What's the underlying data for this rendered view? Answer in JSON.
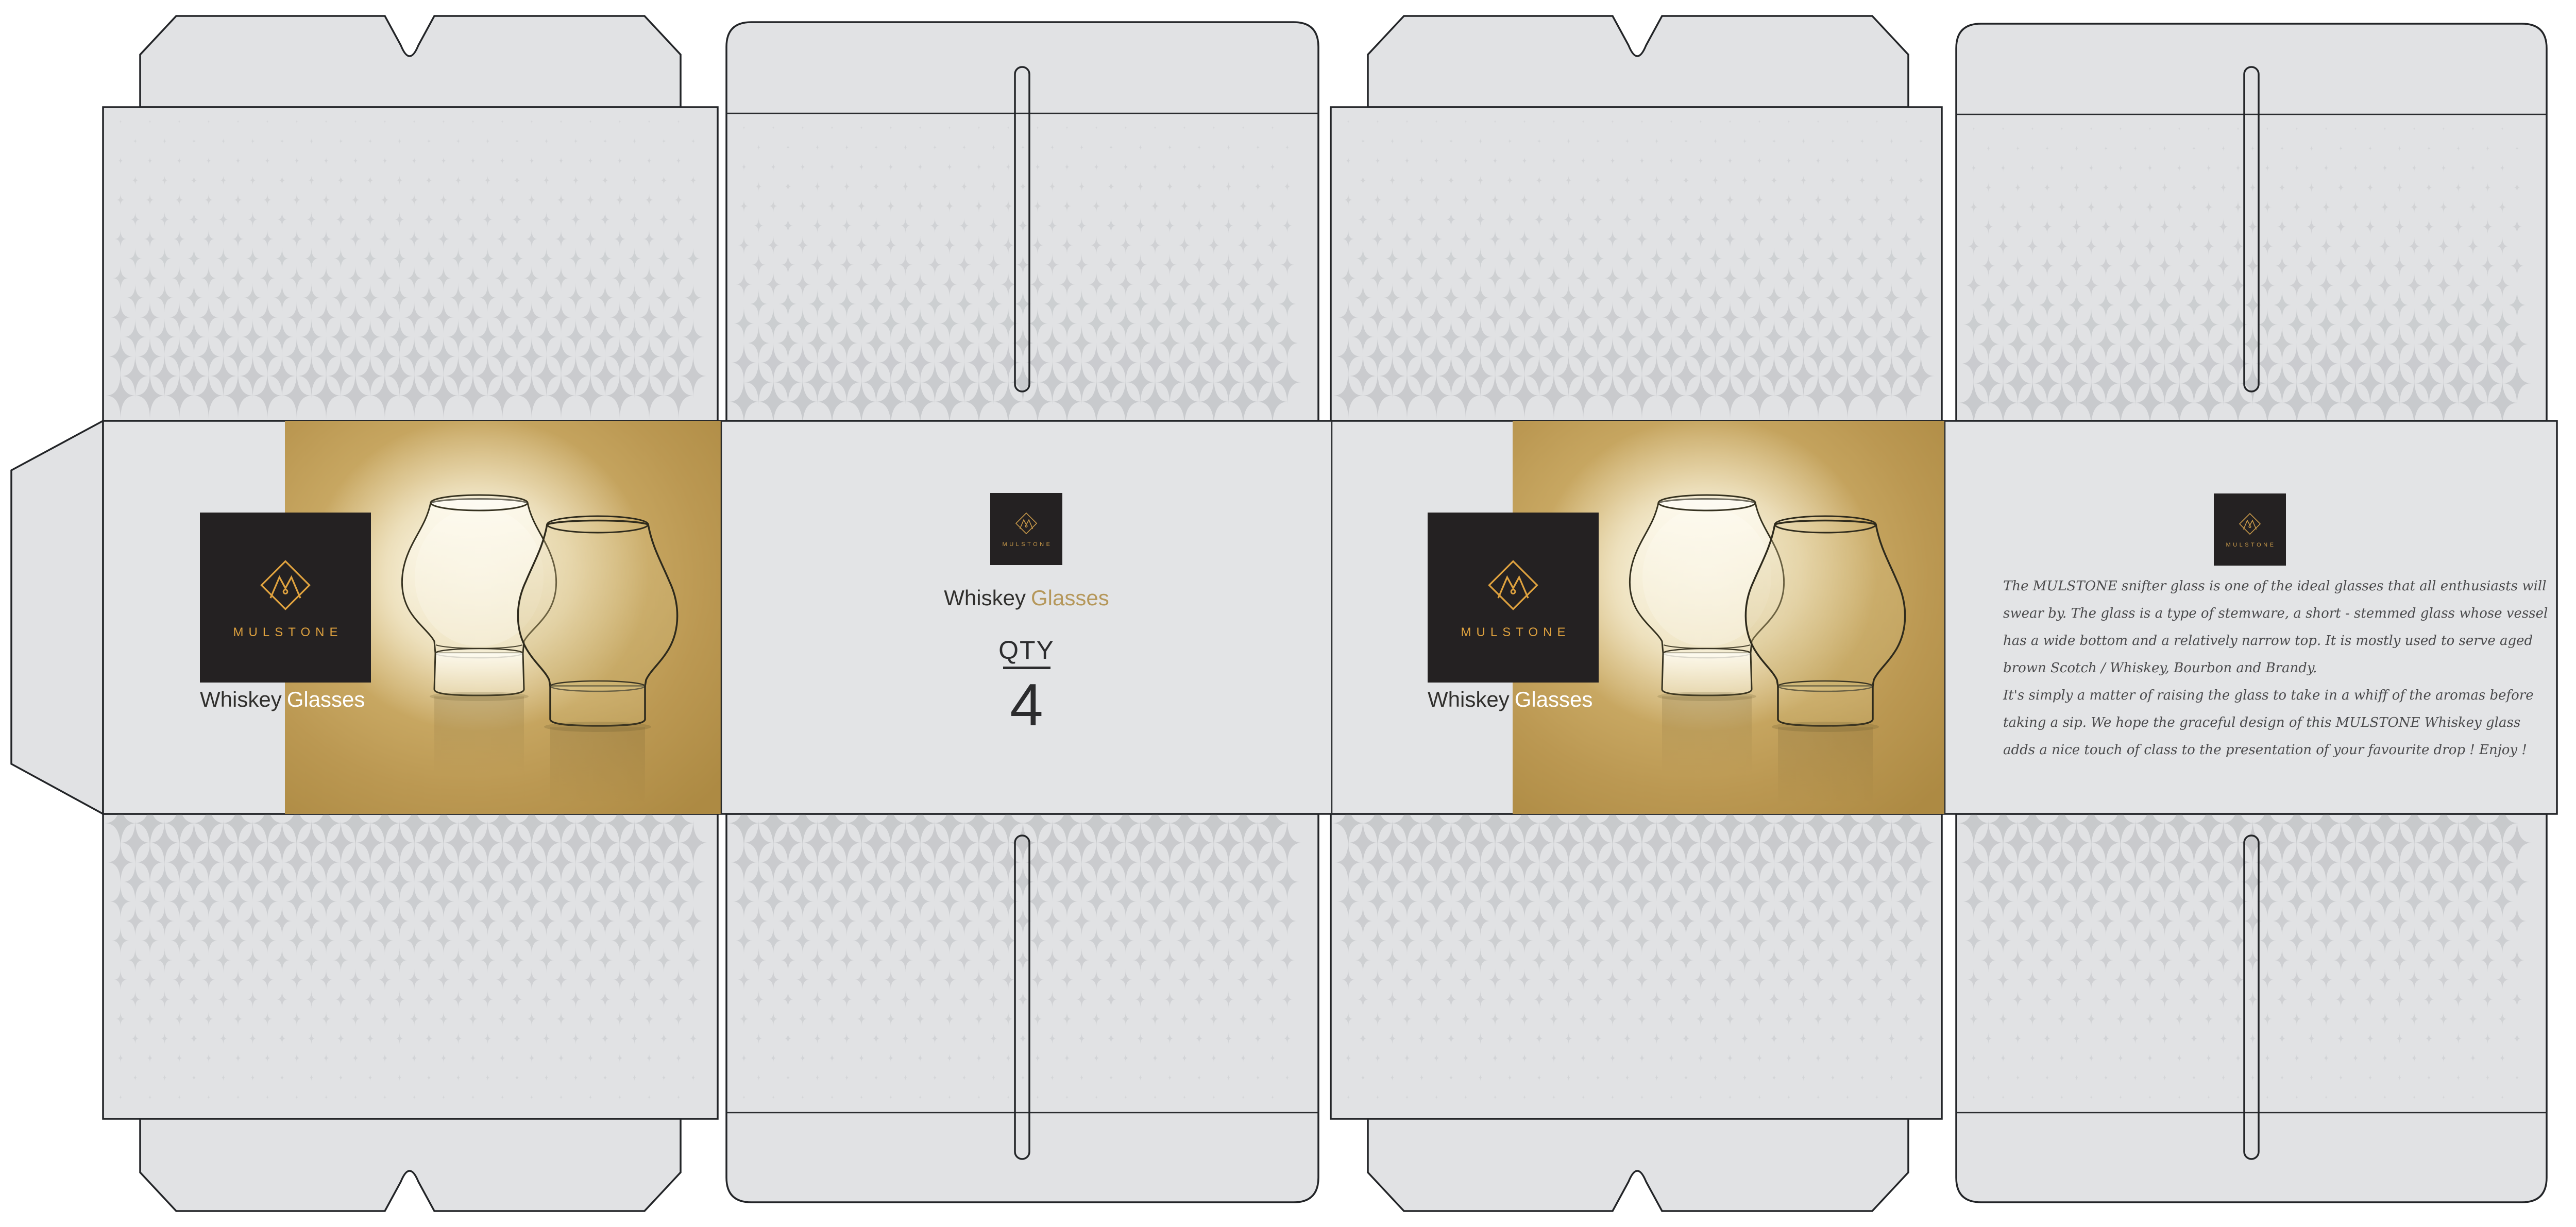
{
  "brand": {
    "wordmark": "MULSTONE",
    "monogram": "M"
  },
  "panels": {
    "front": {
      "title_word1": "Whiskey",
      "title_word2": "Glasses"
    },
    "side_qty": {
      "title_word1": "Whiskey",
      "title_word2": "Glasses",
      "qty_label": "QTY",
      "qty_value": "4"
    },
    "back": {
      "title_word1": "Whiskey",
      "title_word2": "Glasses"
    },
    "side_info": {
      "description_lines": [
        "The MULSTONE snifter glass is one of the ideal glasses that all enthusiasts will",
        "swear by. The glass is a type of stemware, a short - stemmed glass whose vessel",
        "has a wide bottom and a relatively narrow top. It is mostly used to serve aged",
        "brown Scotch / Whiskey, Bourbon and Brandy.",
        "It's simply a matter of raising the glass to take in a whiff of the aromas before",
        "taking a sip. We hope the graceful design of this MULSTONE Whiskey glass",
        "adds a nice touch of class to the presentation of your favourite drop ! Enjoy !"
      ]
    }
  },
  "colors": {
    "board": "#e1e2e4",
    "band": "#e3e4e6",
    "gold": "#c2a058",
    "logo_background": "#242122",
    "logo_gold": "#dfa23f",
    "accent_gold_text": "#b5975a",
    "title_dark": "#302f2d",
    "title_light": "#ffffff",
    "script_text": "#4a4a4c",
    "cut_line": "#232528",
    "halftone_star": "#c3c5c8"
  }
}
